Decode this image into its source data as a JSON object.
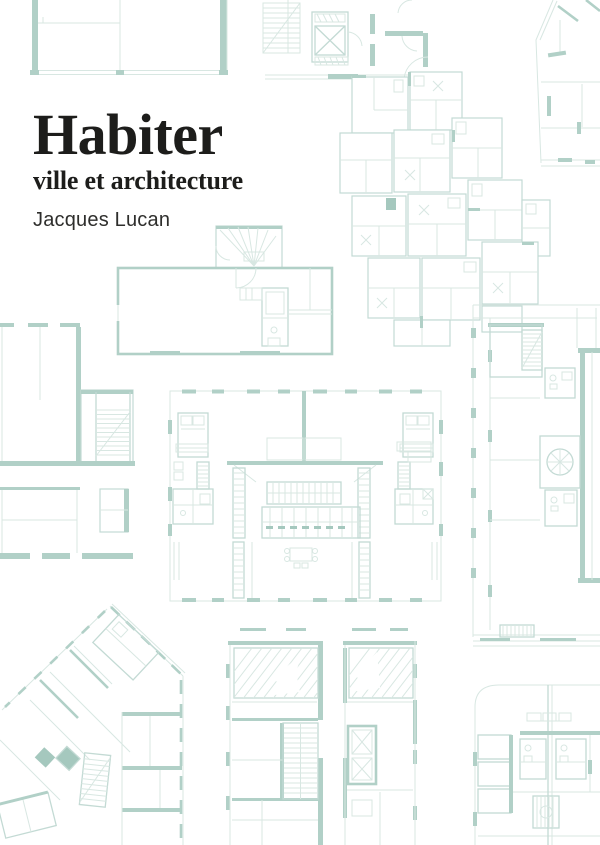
{
  "cover": {
    "title": "Habiter",
    "subtitle": "ville et architecture",
    "author": "Jacques Lucan"
  },
  "colors": {
    "background": "#ffffff",
    "title_text": "#1d1d1b",
    "author_text": "#2e2e2c",
    "plan_thin_line": "#d8e7e2",
    "plan_medium_line": "#c3dad4",
    "plan_wall": "#b1d0c7",
    "plan_dark_fill": "#a5c8be"
  },
  "art": {
    "plans": [
      "floorplan-top-left",
      "floorplan-top-center-stair-elevator",
      "floorplan-top-right-angled",
      "floorplan-cluster-upper-right",
      "floorplan-house-mid-left",
      "floorplan-left-edge",
      "floorplan-center-symmetric",
      "floorplan-right-tower",
      "floorplan-bottom-left-angled",
      "floorplan-bottom-center-towers",
      "floorplan-bottom-right-grid"
    ]
  }
}
